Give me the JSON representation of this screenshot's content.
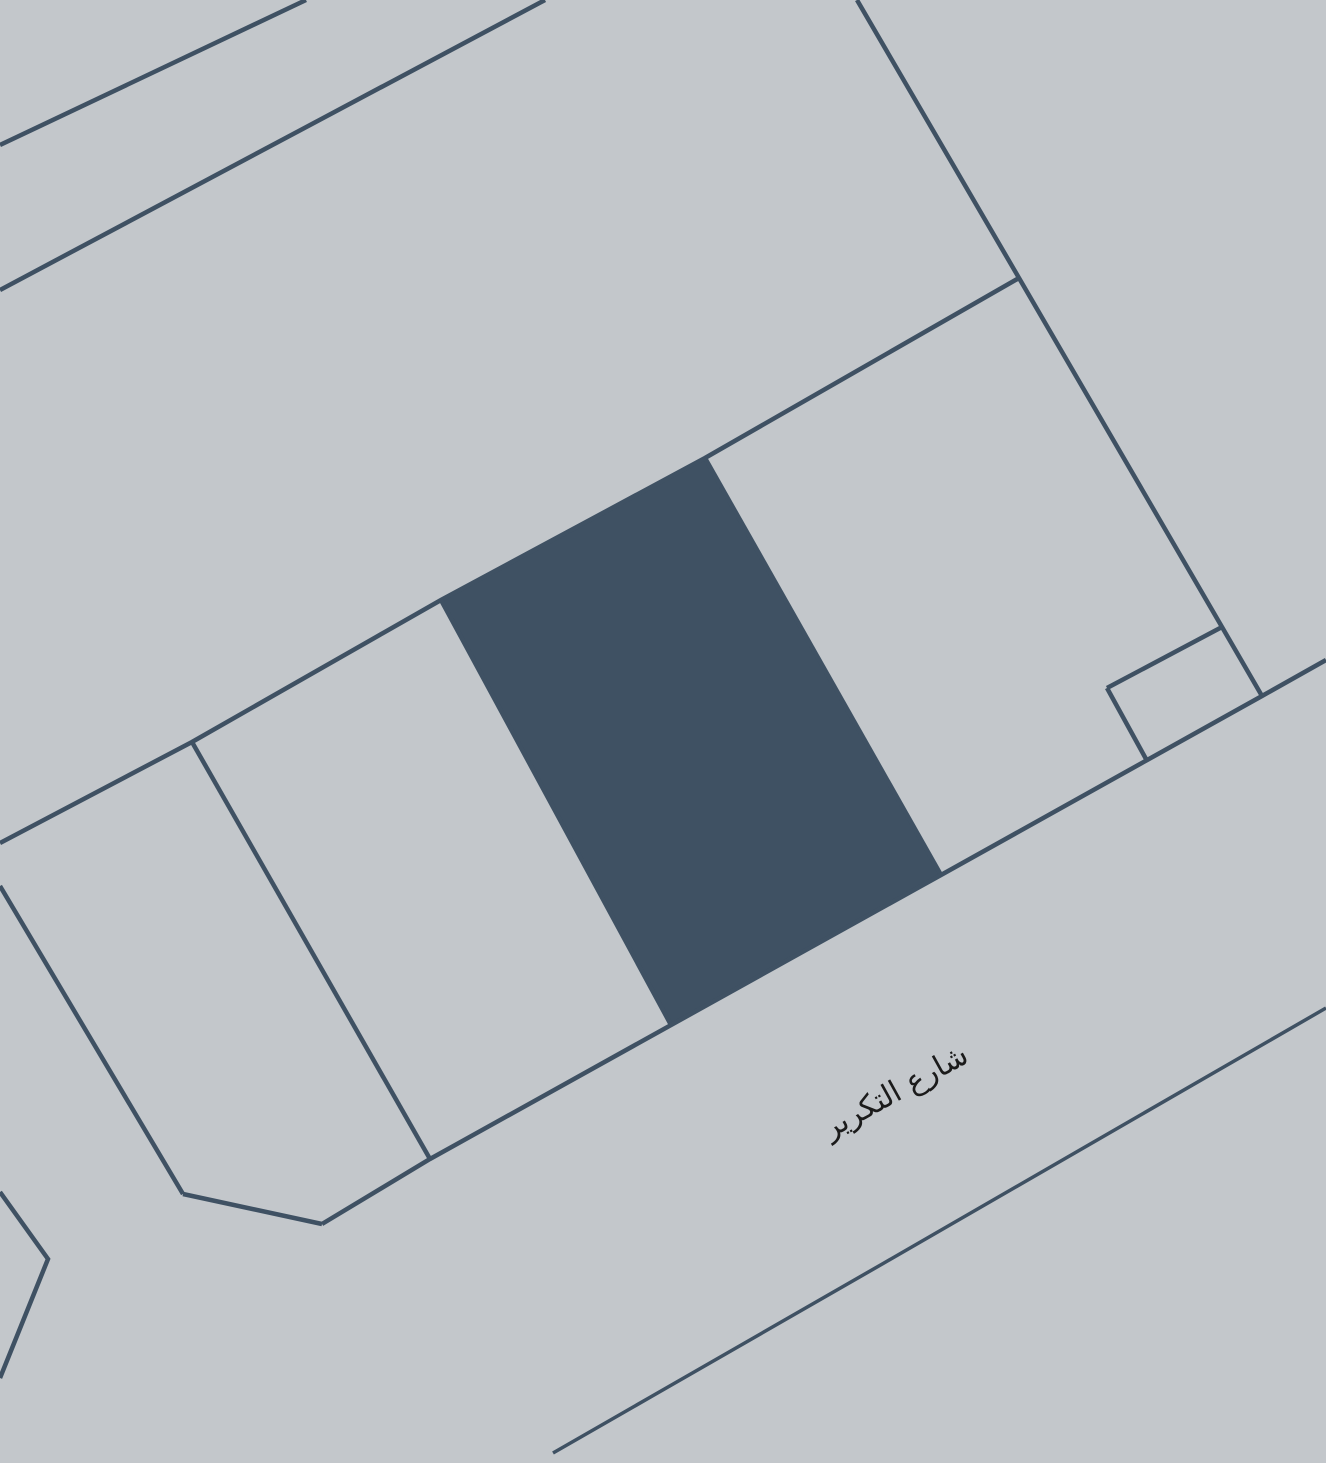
{
  "map": {
    "kind": "cadastral-parcel-map",
    "canvas": {
      "width": 1326,
      "height": 1463
    },
    "colors": {
      "background": "#c3c7cb",
      "parcel_fill": "#3f5163",
      "boundary_line": "#3f5163",
      "label_text": "#1b1b1b"
    },
    "street_label": {
      "text": "شارع التكرير",
      "x": 900,
      "y": 1100,
      "rotation_deg": -29
    },
    "highlighted_parcel": {
      "points": [
        [
          441,
          599
        ],
        [
          705,
          458
        ],
        [
          941,
          875
        ],
        [
          671,
          1025
        ]
      ]
    },
    "boundary_lines": [
      {
        "name": "upper-road-edge-1",
        "width": 4.5,
        "points": [
          [
            306,
            0
          ],
          [
            0,
            145
          ]
        ]
      },
      {
        "name": "upper-road-edge-2",
        "width": 4.5,
        "points": [
          [
            545,
            0
          ],
          [
            0,
            290
          ]
        ]
      },
      {
        "name": "block-east-boundary",
        "width": 4.5,
        "points": [
          [
            857,
            0
          ],
          [
            1019,
            278
          ],
          [
            1222,
            627
          ],
          [
            1262,
            696
          ]
        ]
      },
      {
        "name": "block-north-boundary",
        "width": 4.5,
        "points": [
          [
            0,
            843
          ],
          [
            192,
            742
          ],
          [
            441,
            600
          ],
          [
            705,
            458
          ],
          [
            1019,
            278
          ]
        ]
      },
      {
        "name": "west-parcel-edge",
        "width": 4.5,
        "points": [
          [
            0,
            886
          ],
          [
            183,
            1194
          ]
        ]
      },
      {
        "name": "corner-chamfer",
        "width": 4.5,
        "points": [
          [
            183,
            1194
          ],
          [
            322,
            1224
          ]
        ]
      },
      {
        "name": "parcel-divider-1",
        "width": 4.5,
        "points": [
          [
            192,
            742
          ],
          [
            430,
            1159
          ]
        ]
      },
      {
        "name": "parcel-divider-2",
        "width": 4.5,
        "points": [
          [
            441,
            600
          ],
          [
            671,
            1025
          ]
        ]
      },
      {
        "name": "parcel-divider-3",
        "width": 4.5,
        "points": [
          [
            705,
            458
          ],
          [
            941,
            875
          ]
        ]
      },
      {
        "name": "street-north-edge",
        "width": 4.5,
        "points": [
          [
            322,
            1224
          ],
          [
            430,
            1159
          ],
          [
            941,
            875
          ],
          [
            1262,
            696
          ],
          [
            1326,
            660
          ]
        ]
      },
      {
        "name": "small-parcel-north-edge",
        "width": 4.5,
        "points": [
          [
            1107,
            688
          ],
          [
            1222,
            627
          ]
        ]
      },
      {
        "name": "small-parcel-west-edge",
        "width": 4.5,
        "points": [
          [
            1107,
            688
          ],
          [
            1146,
            759
          ]
        ]
      },
      {
        "name": "street-south-edge",
        "width": 3.5,
        "points": [
          [
            553,
            1453
          ],
          [
            884,
            1263
          ],
          [
            1326,
            1008
          ]
        ]
      },
      {
        "name": "southwest-parcel-corner",
        "width": 4.5,
        "points": [
          [
            0,
            1192
          ],
          [
            48,
            1259
          ],
          [
            0,
            1378
          ]
        ]
      }
    ]
  }
}
